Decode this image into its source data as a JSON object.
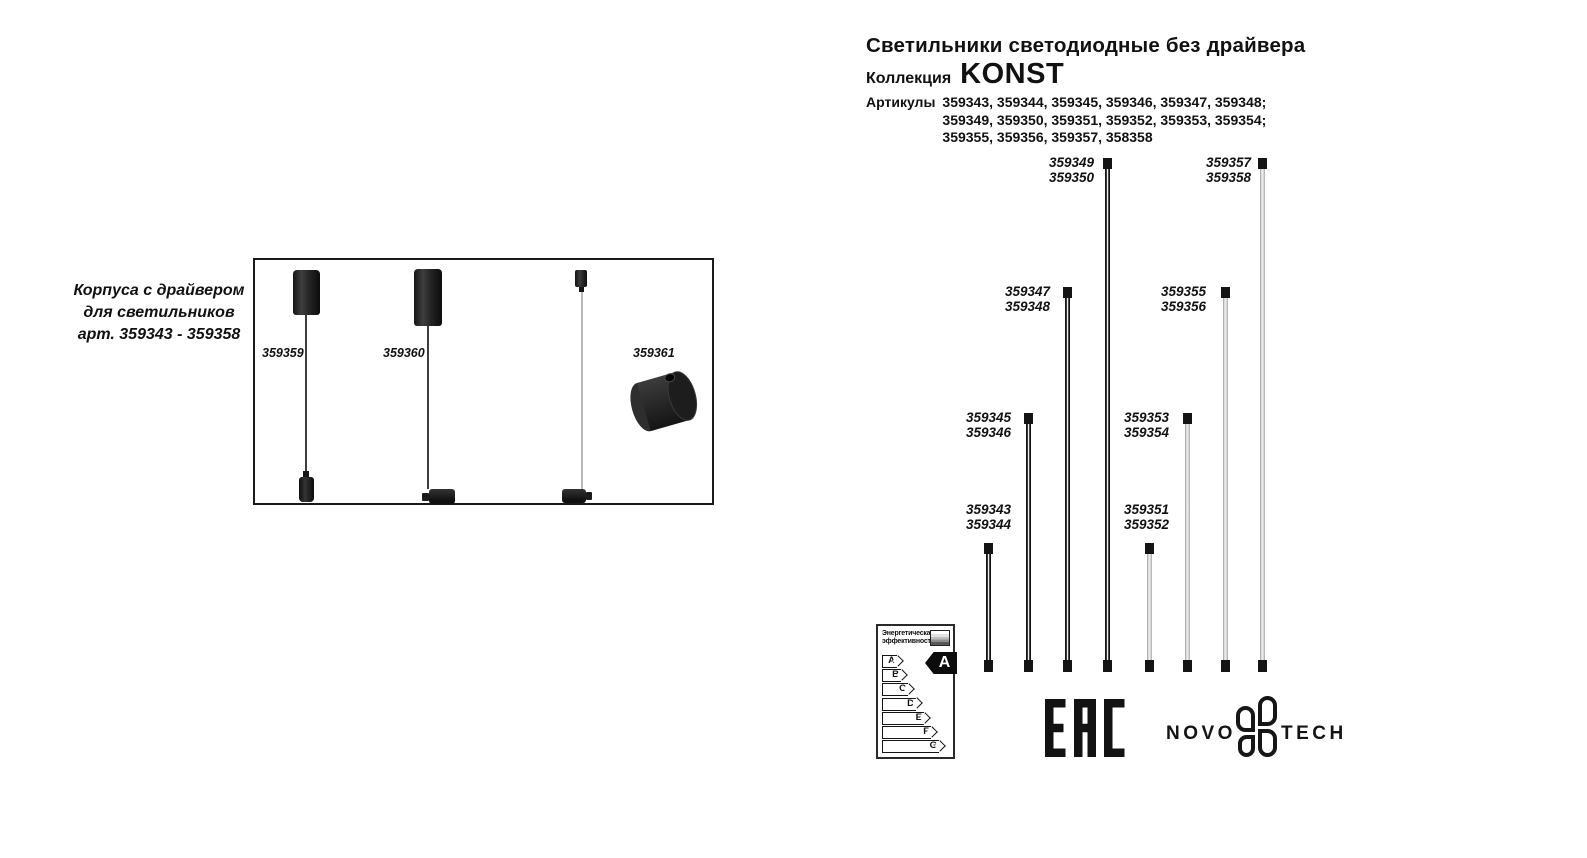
{
  "header": {
    "title": "Светильники светодиодные без драйвера",
    "collection_label": "Коллекция",
    "collection_name": "KONST",
    "articles_label": "Артикулы",
    "articles_lines": [
      "359343, 359344, 359345, 359346, 359347, 359348;",
      "359349, 359350, 359351, 359352, 359353, 359354;",
      "359355, 359356, 359357, 358358"
    ]
  },
  "left_panel": {
    "caption_lines": [
      "Корпуса с драйвером",
      "для светильников",
      "арт. 359343 - 359358"
    ],
    "items": [
      {
        "label": "359359"
      },
      {
        "label": "359360"
      },
      {
        "label": "359361"
      }
    ]
  },
  "diagram": {
    "tubes": [
      {
        "lines": [
          "359343",
          "359344"
        ],
        "color": "black"
      },
      {
        "lines": [
          "359345",
          "359346"
        ],
        "color": "black"
      },
      {
        "lines": [
          "359347",
          "359348"
        ],
        "color": "black"
      },
      {
        "lines": [
          "359349",
          "359350"
        ],
        "color": "black"
      },
      {
        "lines": [
          "359351",
          "359352"
        ],
        "color": "white"
      },
      {
        "lines": [
          "359353",
          "359354"
        ],
        "color": "white"
      },
      {
        "lines": [
          "359355",
          "359356"
        ],
        "color": "white"
      },
      {
        "lines": [
          "359357",
          "359358"
        ],
        "color": "white"
      }
    ]
  },
  "energy_label": {
    "header_lines": [
      "Энергетическая",
      "эффективность"
    ],
    "classes": [
      "A",
      "B",
      "C",
      "D",
      "E",
      "F",
      "G"
    ],
    "rating": "A"
  },
  "logos": {
    "eac": "EAC",
    "brand_left": "NOVO",
    "brand_right": "TECH"
  },
  "icons": {
    "eac_mark": "eac-certification-mark-icon",
    "brand_flower": "novotech-flower-icon",
    "energy_scale": "energy-gradient-stripes-icon"
  },
  "colors": {
    "ink": "#111111",
    "tube_black": "#161616",
    "tube_white": "#e7e7e7",
    "background": "#ffffff"
  }
}
